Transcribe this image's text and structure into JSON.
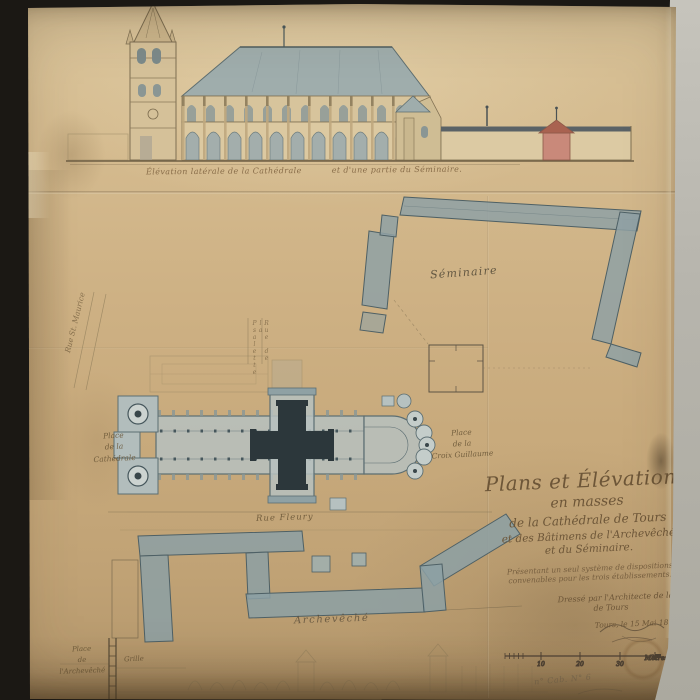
{
  "colors": {
    "paper": "#cdb083",
    "paper_light": "#d8c298",
    "paper_dark": "#b2956a",
    "ink": "#5a4a34",
    "wash": "#8fa1a4",
    "wash_dark": "#4e6065",
    "crossing_dark": "#2c373b",
    "roof_gray": "#9fadac",
    "red_building": "#c9897a",
    "background": "#1b1814",
    "wall_gray": "#b7b5ad"
  },
  "elevation": {
    "caption_part1": "Élévation latérale de la Cathédrale",
    "caption_part2": "et d'une partie du Séminaire."
  },
  "plan_labels": {
    "seminaire": "Séminaire",
    "rue_st_maurice": "Rue St. Maurice",
    "rue_psalette": "Rue de la Psalette",
    "place_cathedrale": [
      "Place",
      "de la",
      "Cathédrale"
    ],
    "place_croix_guillaume": [
      "Place",
      "de la",
      "Croix Guillaume"
    ],
    "rue_fleury": "Rue Fleury",
    "archeveche": "Archevêché",
    "place_archeveche": [
      "Place",
      "de",
      "l'Archevêché"
    ],
    "grille": "Grille"
  },
  "title_block": {
    "line1": "Plans et Élévations",
    "line2": "en masses",
    "line3": "de la Cathédrale de Tours",
    "line4": "et des Bâtimens de l'Archevêché",
    "line5": "et du Séminaire.",
    "sub1": "Présentant un seul système de dispositions",
    "sub2": "convenables pour les trois établissements.",
    "byline1": "Dressé par l'Architecte de la Ville",
    "byline2": "de Tours",
    "dateline": "Tours, le 15 Mai 18.."
  },
  "scale_bar": {
    "tick1": "10",
    "tick2": "20",
    "tick3": "30",
    "unit": "Mètres"
  },
  "pencil_note": "n° Cab. N° 6"
}
